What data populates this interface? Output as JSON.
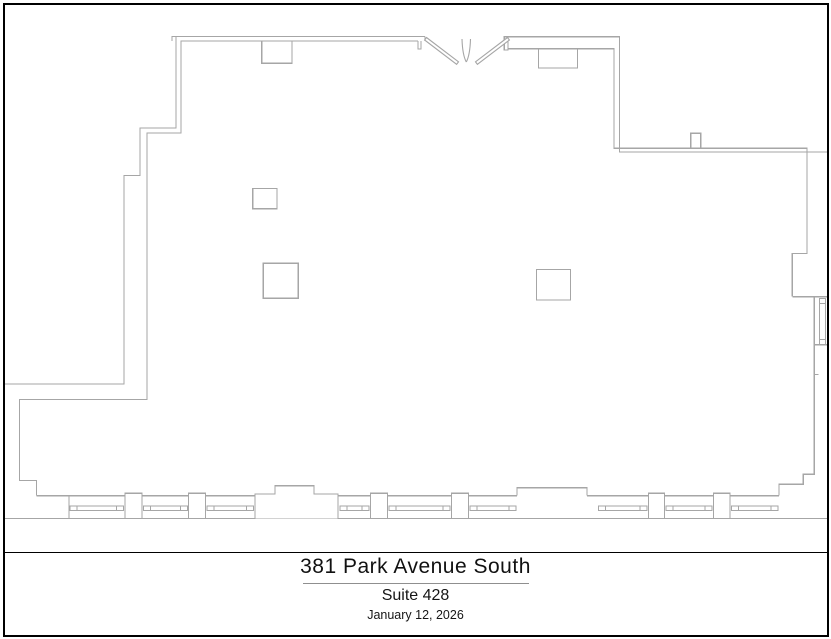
{
  "title_block": {
    "building_name": "381 Park Avenue South",
    "suite": "Suite 428",
    "date": "January 12, 2026"
  },
  "drawing": {
    "type": "floor-plan",
    "features": [
      "outer-wall-outline",
      "inner-wall-outline",
      "double-entry-doors-with-swing-arcs",
      "interior-columns",
      "window-band-bottom",
      "window-right-wall",
      "window-piers",
      "bay-projections"
    ]
  },
  "colors": {
    "wall_line": "#a6a6a6",
    "frame": "#000000",
    "background": "#ffffff",
    "text": "#1c1c1c"
  }
}
